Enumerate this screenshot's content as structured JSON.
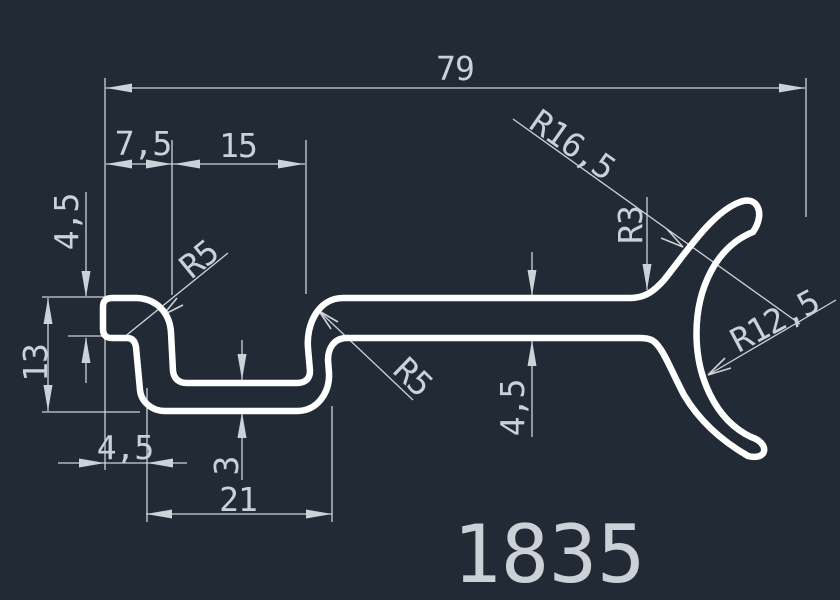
{
  "colors": {
    "background": "#212a35",
    "profile": "#ffffff",
    "dimension": "#cdd2d9",
    "text": "#ccd1d8"
  },
  "labels": {
    "total_width": "79",
    "tab_offset": "7,5",
    "slot_width": "15",
    "tab_thickness": "4,5",
    "overall_depth": "13",
    "radius_tab": "R5",
    "radius_wall": "R5",
    "base_offset": "4,5",
    "base_thickness": "3",
    "base_width": "21",
    "radius_outer_arc": "R16,5",
    "radius_fillet": "R3",
    "radius_inner_arc": "R12,5",
    "arm_thickness": "4,5",
    "part_number": "1835"
  }
}
